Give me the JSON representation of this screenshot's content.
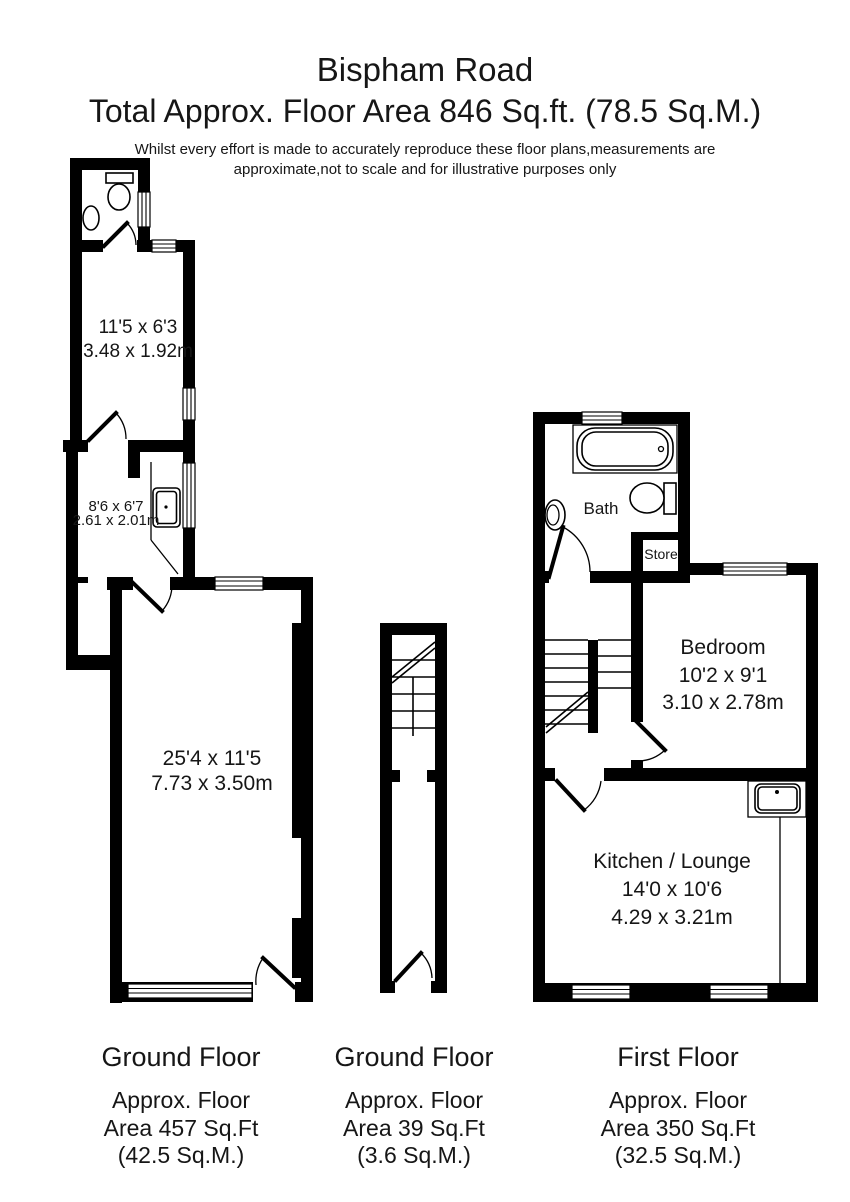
{
  "header": {
    "title": "Bispham Road",
    "subtitle": "Total Approx. Floor Area 846 Sq.ft. (78.5 Sq.M.)",
    "disclaimer_line1": "Whilst every effort is made to accurately reproduce these floor plans,measurements are",
    "disclaimer_line2": "approximate,not to scale and for illustrative purposes only"
  },
  "plans": {
    "ground_floor_main": {
      "room_top": {
        "line1": "11'5 x 6'3",
        "line2": "3.48 x 1.92m"
      },
      "room_mid": {
        "line1": "8'6 x 6'7",
        "line2": "2.61 x 2.01m"
      },
      "room_main": {
        "line1": "25'4 x 11'5",
        "line2": "7.73 x 3.50m"
      }
    },
    "first_floor": {
      "bath_label": "Bath",
      "store_label": "Store",
      "bedroom": {
        "name": "Bedroom",
        "line1": "10'2 x 9'1",
        "line2": "3.10 x 2.78m"
      },
      "kitchen": {
        "name": "Kitchen / Lounge",
        "line1": "14'0 x 10'6",
        "line2": "4.29 x 3.21m"
      }
    }
  },
  "footers": [
    {
      "title": "Ground Floor",
      "line1": "Approx. Floor",
      "line2": "Area 457 Sq.Ft",
      "line3": "(42.5 Sq.M.)"
    },
    {
      "title": "Ground Floor",
      "line1": "Approx. Floor",
      "line2": "Area 39 Sq.Ft",
      "line3": "(3.6 Sq.M.)"
    },
    {
      "title": "First Floor",
      "line1": "Approx. Floor",
      "line2": "Area 350 Sq.Ft",
      "line3": "(32.5 Sq.M.)"
    }
  ],
  "colors": {
    "wall": "#000000",
    "background": "#ffffff",
    "text": "#161616"
  }
}
